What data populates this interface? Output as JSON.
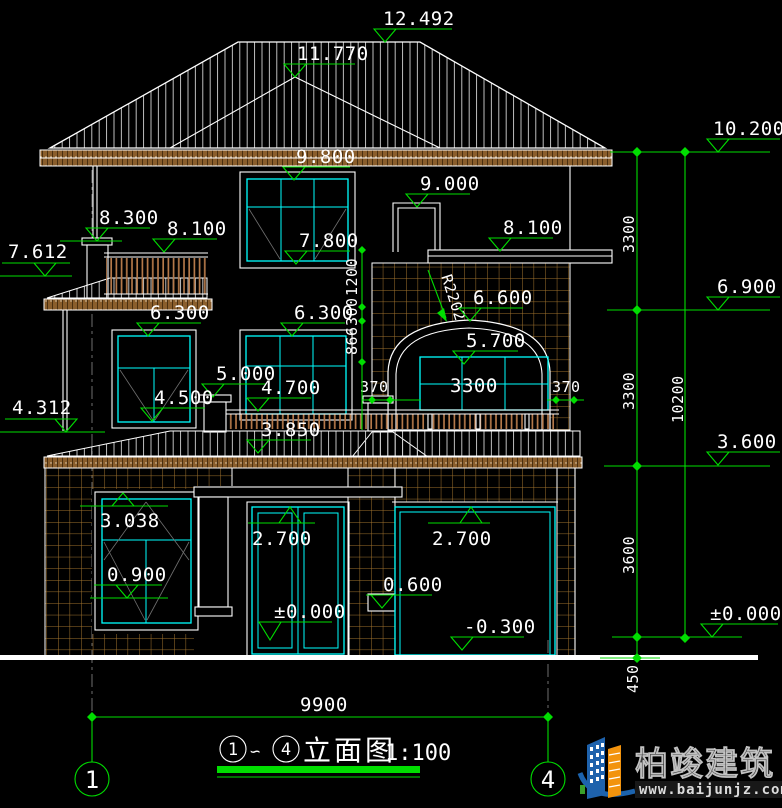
{
  "drawing": {
    "type": "architectural-elevation",
    "colors": {
      "background": "#000000",
      "linework": "#ffffff",
      "dimension_green": "#00de00",
      "window_cyan": "#00ffff",
      "brick_hatch": "#a4752f",
      "logo_blue": "#1c63ad",
      "logo_orange": "#f2930d"
    },
    "elevations": {
      "ridge": "12.492",
      "ridge_lower": "11.770",
      "eave_right": "10.200",
      "eave_soffit": "9.800",
      "stair_door_head": "9.000",
      "left_parapet": "8.300",
      "balcony3_rail": "8.100",
      "terrace_parapet": "8.100",
      "window3_sill": "7.800",
      "canopy3_left": "7.612",
      "floor3_level": "6.900",
      "arch_top": "6.600",
      "window2_left_head": "6.300",
      "window2_mid_head": "6.300",
      "arch_window_head": "5.700",
      "chimney2_top": "5.000",
      "window2_mid_sill": "4.700",
      "window2_left_sill": "4.500",
      "slab2_left": "4.312",
      "balcony2_rail": "3.850",
      "floor2_level": "3.600",
      "window1_head": "3.038",
      "door_head": "2.700",
      "garage_head": "2.700",
      "window1_sill": "0.900",
      "side_ledge": "0.600",
      "door_floor": "±0.000",
      "garage_floor": "-0.300",
      "ground_level": "±0.000"
    },
    "linear_dims": {
      "arch_pier_left": "370",
      "arch_width": "3300",
      "arch_pier_right": "370",
      "arch_radius": "R2202",
      "wall_seg_top": "1200",
      "wall_seg_mid": "300",
      "wall_seg_bottom": "866",
      "floor3_height": "3300",
      "floor2_height": "3300",
      "floor1_height": "3600",
      "plinth": "450",
      "total_height": "10200",
      "total_width": "9900"
    },
    "axis_bubbles": {
      "left": "1",
      "right": "4"
    },
    "title_block": {
      "from_axis": "1",
      "tilde": "∽",
      "to_axis": "4",
      "name": "立面图",
      "scale": "1:100"
    },
    "logo": {
      "company": "柏竣建筑",
      "website": "www.baijunjz.com"
    }
  }
}
